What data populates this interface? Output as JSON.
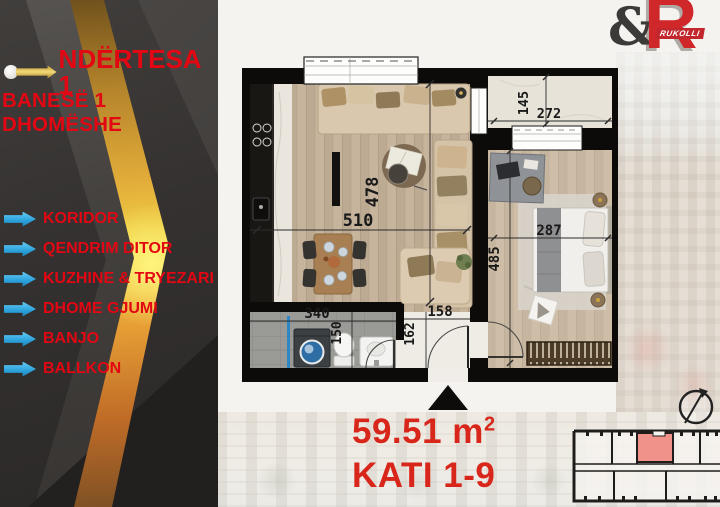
{
  "brand": {
    "ampersand": "&",
    "initial": "R",
    "name": "RUKOLLI"
  },
  "sidebar": {
    "title": "NDËRTESA 1",
    "subtitle": "BANESË 1 DHOMËSHE",
    "rooms": [
      {
        "label": "KORIDOR"
      },
      {
        "label": "QENDRIM DITOR"
      },
      {
        "label": "KUZHINE & TRYEZARI"
      },
      {
        "label": "DHOME GJUMI"
      },
      {
        "label": "BANJO"
      },
      {
        "label": "BALLKON"
      }
    ]
  },
  "floorplan": {
    "dimensions": {
      "living_width": "510",
      "living_height": "478",
      "balcony_height": "145",
      "balcony_width": "272",
      "bedroom_width": "287",
      "bedroom_height": "485",
      "bathroom_width": "340",
      "bathroom_height": "150",
      "hall_width": "158",
      "hall_height": "162"
    }
  },
  "footer": {
    "area": "59.51 m",
    "area_exponent": "2",
    "floors": "KATI 1-9"
  },
  "colors": {
    "accent_red": "#e30613",
    "footer_red": "#d8261b",
    "gold": "#e8b53a",
    "list_blue": "#2da4dd",
    "keyplan_highlight": "#f0928a"
  }
}
